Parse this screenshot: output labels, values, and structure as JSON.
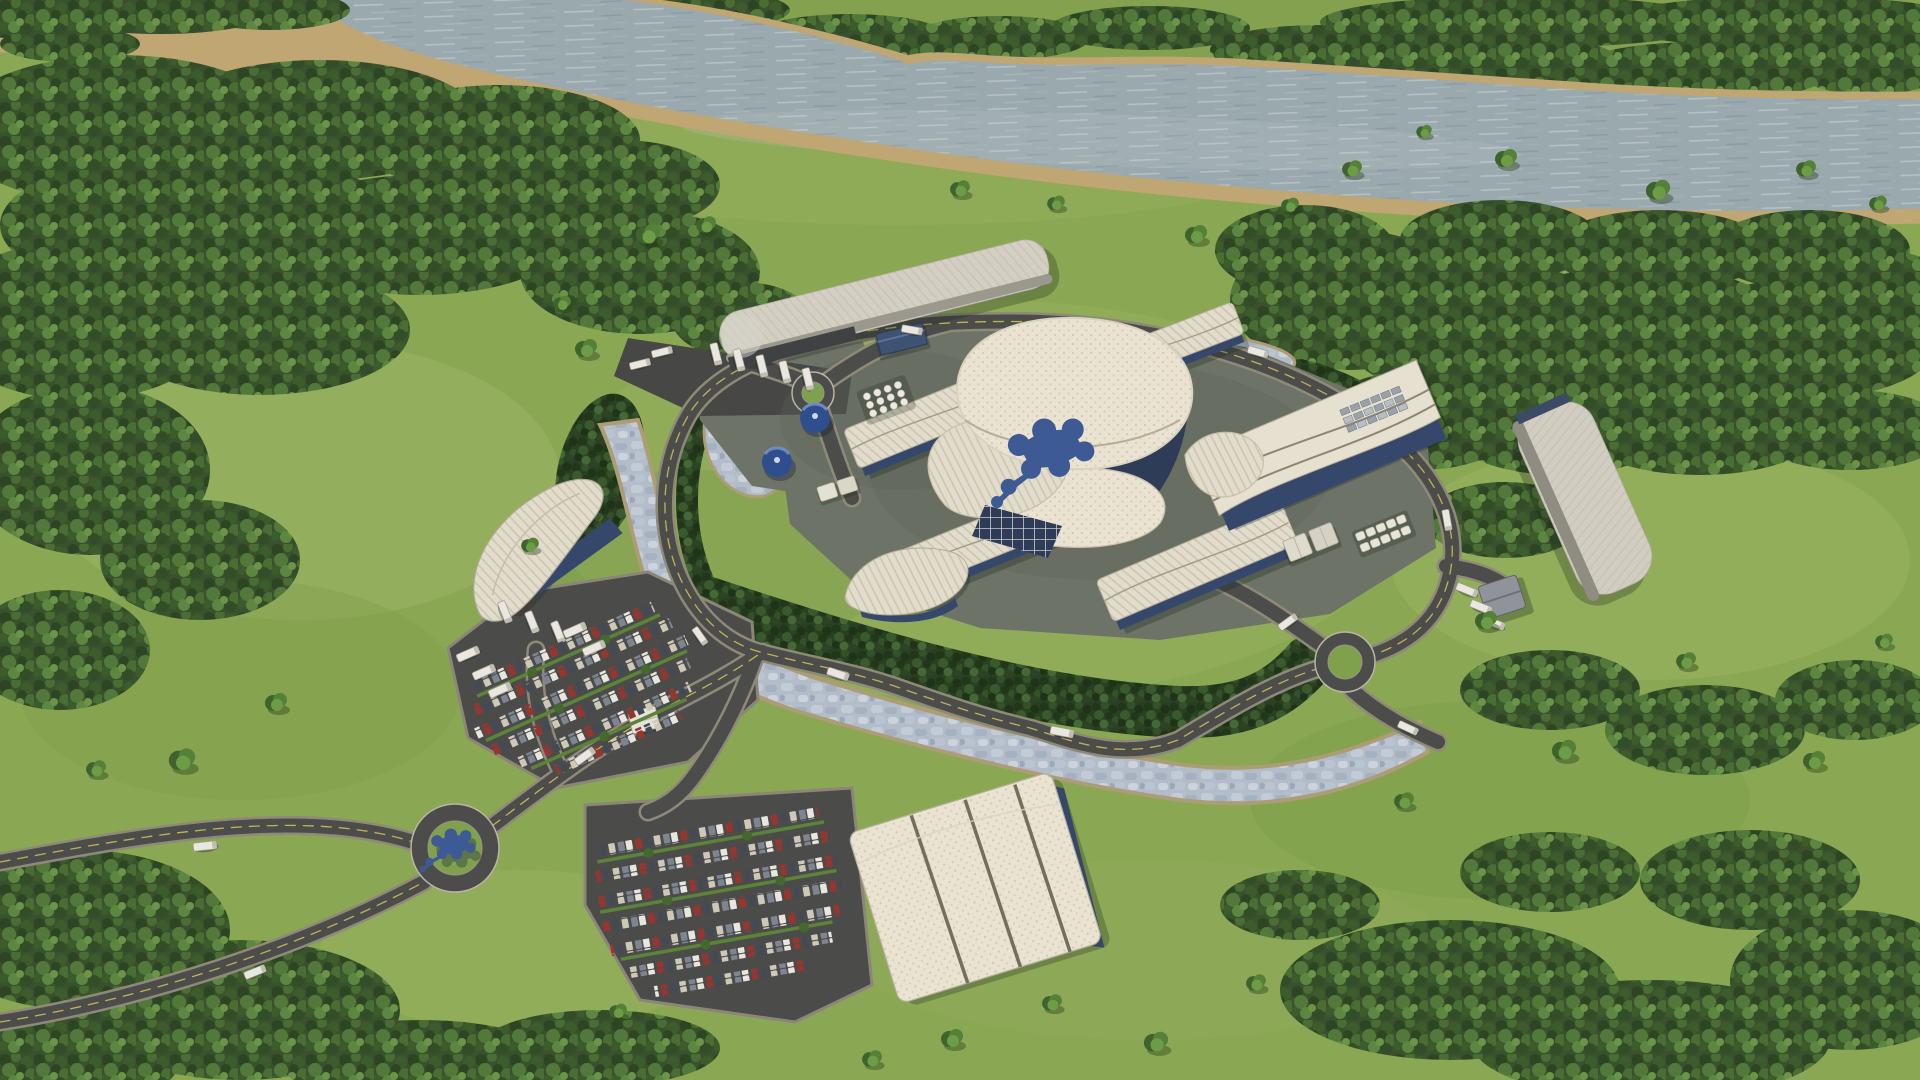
{
  "scene": {
    "description": "Sunny aerial 3D rendering of a circular power-plant campus: central white wavy-shell building with a blue molecule emblem on the roof, rectangular buildings with ribbed white roofs and navy glass bases, a ring road with hedge arcs, a pale stone canal crescent, two blue water tanks, truck docks, parking lots full of cars, three roundabouts (one with a blue molecule sculpture), all set in green fields and forest beside a wide gray river with sandy banks"
  },
  "colors": {
    "grass": "#8aa853",
    "grass_light": "#a9bf70",
    "grass_dark": "#6e8f42",
    "forest": "#39512c",
    "hedge": "#2a4022",
    "river": "#9aa9ae",
    "sand": "#bfa672",
    "road": "#4c4d4b",
    "road_shoulder": "#8f8a78",
    "lane_marking": "#cdbf55",
    "canal": "#b3bdca",
    "pad": "#6d7366",
    "roof_white": "#e6e0d0",
    "roof_gray": "#c7c4bb",
    "glass_navy": "#35486b",
    "logo_blue": "#3d5a94",
    "truck_white": "#e9e7df",
    "tank_blue": "#2f4e8e"
  }
}
